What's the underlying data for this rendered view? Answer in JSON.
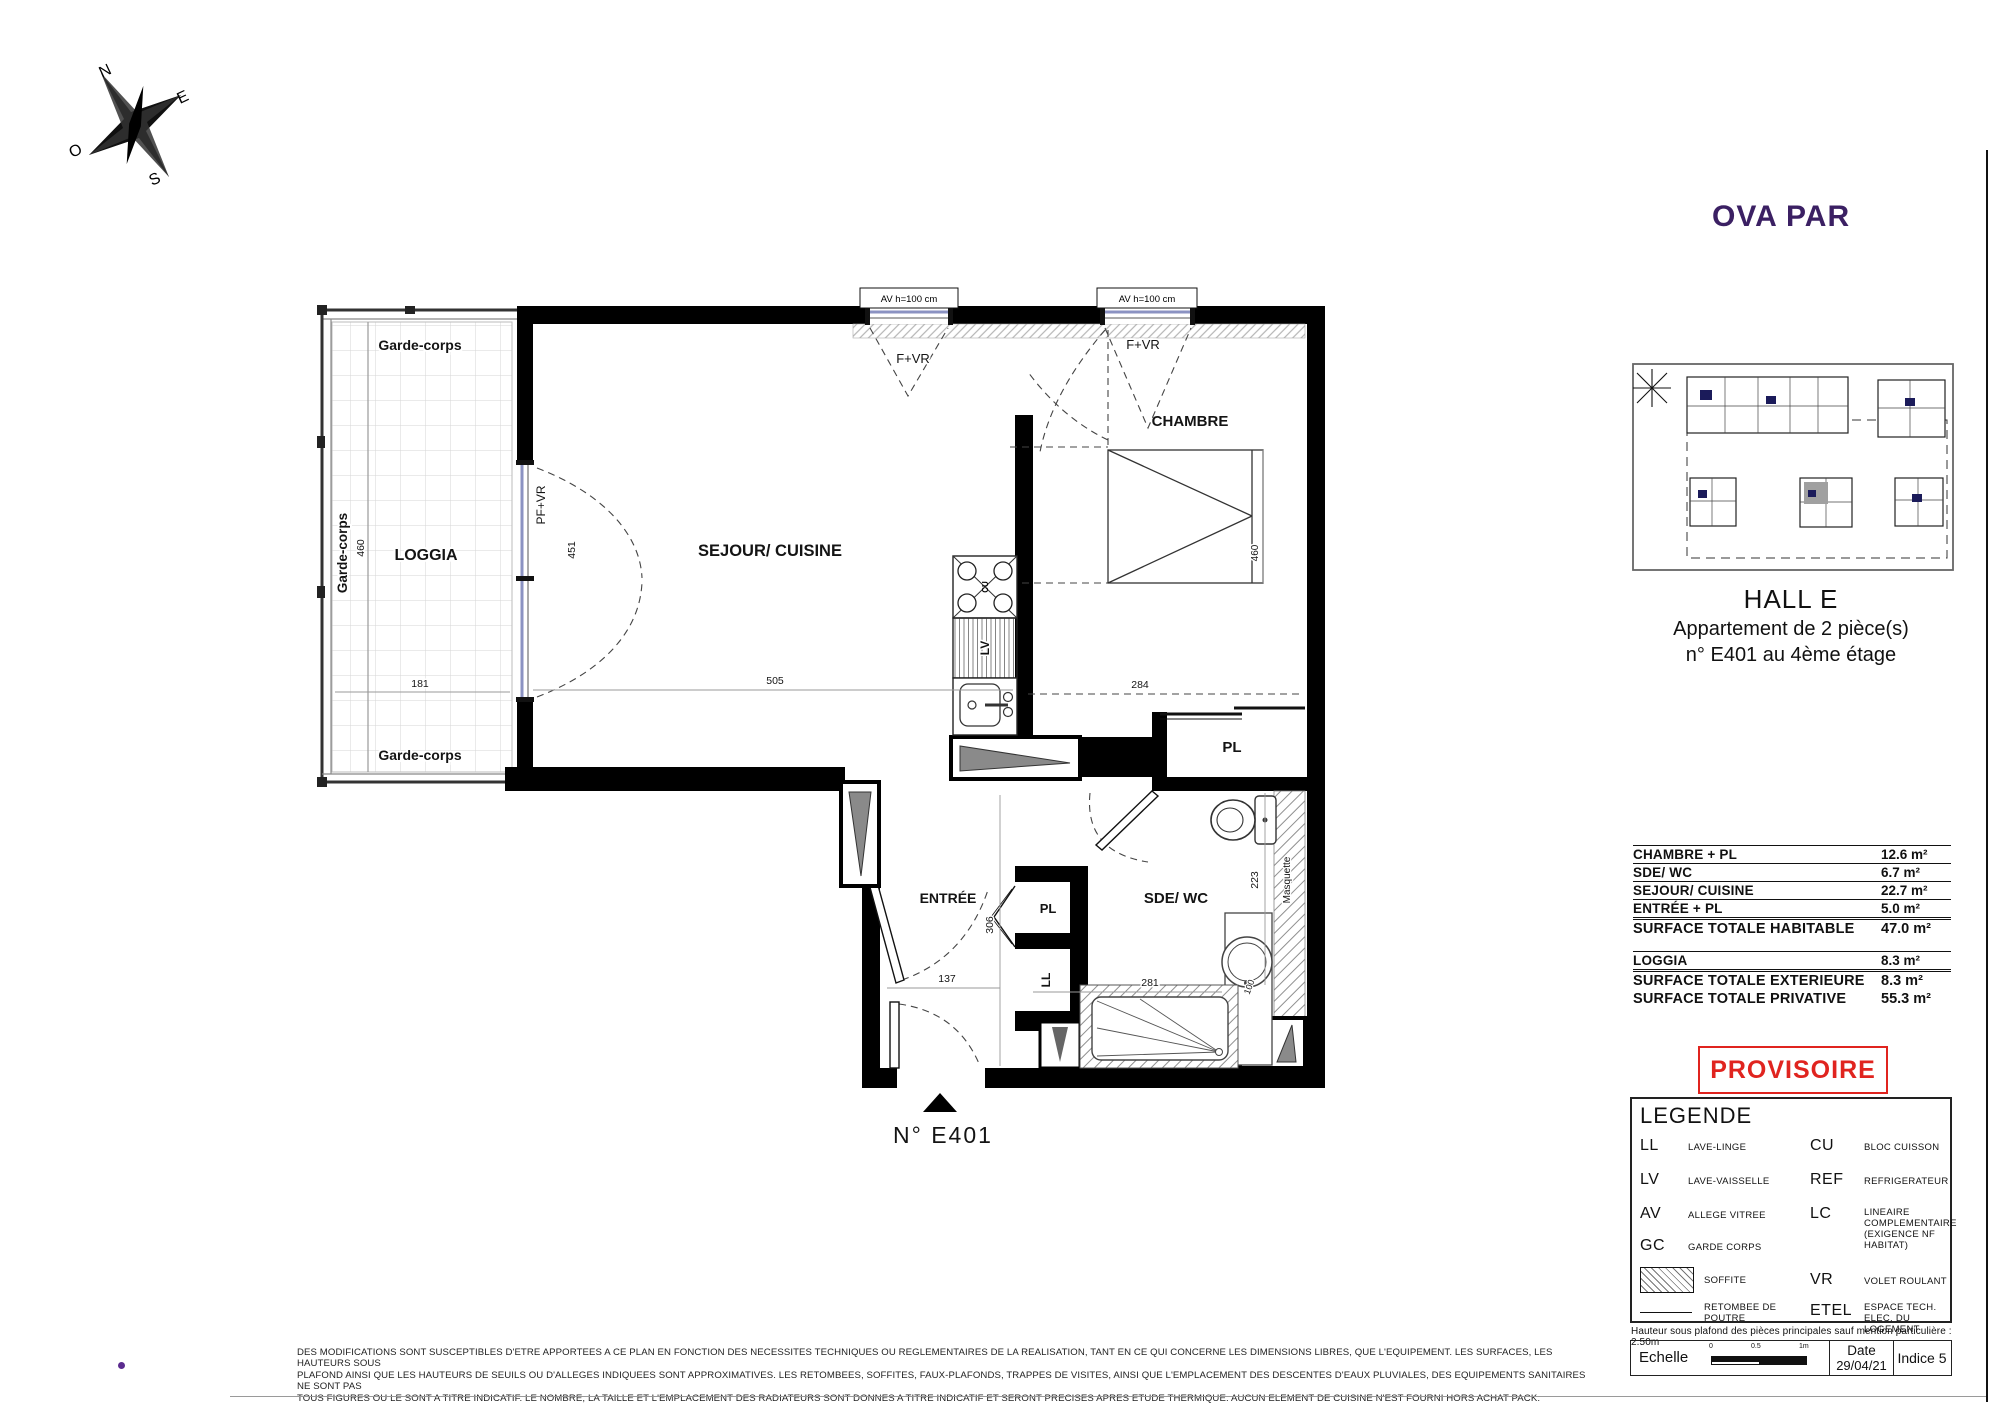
{
  "page": {
    "logo": "OVA PAR",
    "logo_color": "#3b2063",
    "accent_red": "#e0241f",
    "navy": "#1b1b5a"
  },
  "compass": {
    "n": "N",
    "e": "E",
    "s": "S",
    "o": "O"
  },
  "plan": {
    "rooms": {
      "loggia": "LOGGIA",
      "sejour": "SEJOUR/ CUISINE",
      "chambre": "CHAMBRE",
      "entree": "ENTRÉE",
      "sde": "SDE/ WC",
      "pl_chambre": "PL",
      "pl_entree": "PL",
      "ll": "LL",
      "lv": "LV",
      "cu": "CU"
    },
    "labels": {
      "garde_corps": "Garde-corps",
      "pf_vr": "PF+VR",
      "f_vr": "F+VR",
      "av": "AV h=100 cm",
      "masquette": "Masquette",
      "unit": "N°  E401"
    },
    "dims": {
      "loggia_w": "181",
      "loggia_h": "460",
      "sejour_w": "505",
      "sejour_door": "451",
      "chambre_w": "284",
      "chambre_h": "460",
      "entree_w": "137",
      "entree_h": "306",
      "sde_w": "281",
      "sde_h": "223",
      "vasque": "100"
    }
  },
  "sidebar": {
    "hall": "HALL E",
    "apt_line1": "Appartement de 2 pièce(s)",
    "apt_line2": "n° E401 au  4ème étage",
    "surface_table": {
      "rows": [
        {
          "label": "CHAMBRE  + PL",
          "value": "12.6 m²"
        },
        {
          "label": "SDE/ WC",
          "value": "6.7 m²"
        },
        {
          "label": "SEJOUR/ CUISINE",
          "value": "22.7 m²"
        },
        {
          "label": "ENTRÉE  + PL",
          "value": "5.0 m²"
        },
        {
          "label": "SURFACE TOTALE HABITABLE",
          "value": "47.0 m²"
        },
        {
          "label": "LOGGIA",
          "value": "8.3 m²"
        },
        {
          "label": "SURFACE TOTALE EXTERIEURE",
          "value": "8.3 m²"
        },
        {
          "label": "SURFACE TOTALE PRIVATIVE",
          "value": "55.3 m²"
        }
      ]
    },
    "stamp": "PROVISOIRE",
    "legend": {
      "title": "LEGENDE",
      "ll_abbr": "LL",
      "ll_desc": "LAVE-LINGE",
      "lv_abbr": "LV",
      "lv_desc": "LAVE-VAISSELLE",
      "av_abbr": "AV",
      "av_desc": "ALLEGE VITREE",
      "gc_abbr": "GC",
      "gc_desc": "GARDE CORPS",
      "soffite_desc": "SOFFITE",
      "retombee_desc": "RETOMBEE DE POUTRE",
      "cu_abbr": "CU",
      "cu_desc": "BLOC CUISSON",
      "ref_abbr": "REF",
      "ref_desc": "REFRIGERATEUR",
      "lc_abbr": "LC",
      "lc_desc": "LINEAIRE COMPLEMENTAIRE (EXIGENCE NF HABITAT)",
      "vr_abbr": "VR",
      "vr_desc": "VOLET ROULANT",
      "etel_abbr": "ETEL",
      "etel_desc": "ESPACE TECH. ELEC. DU LOGEMENT"
    },
    "ceiling_note": "Hauteur sous plafond des pièces principales sauf mention particulière : 2.50m",
    "titlebar": {
      "echelle": "Echelle",
      "tick0": "0",
      "tick05": "0.5",
      "tick1": "1m",
      "date_label": "Date",
      "date_value": "29/04/21",
      "indice": "Indice 5"
    }
  },
  "disclaimer": {
    "line1": "DES MODIFICATIONS SONT SUSCEPTIBLES D'ETRE APPORTEES A CE PLAN EN FONCTION DES NECESSITES TECHNIQUES OU REGLEMENTAIRES DE LA REALISATION, TANT EN CE QUI CONCERNE LES DIMENSIONS LIBRES, QUE L'EQUIPEMENT. LES SURFACES, LES HAUTEURS SOUS",
    "line2": "PLAFOND AINSI QUE LES HAUTEURS DE SEUILS OU D'ALLEGES INDIQUEES SONT APPROXIMATIVES. LES RETOMBEES, SOFFITES, FAUX-PLAFONDS, TRAPPES DE VISITES, AINSI QUE L'EMPLACEMENT DES DESCENTES D'EAUX PLUVIALES, DES EQUIPEMENTS SANITAIRES NE SONT PAS",
    "line3": "TOUS FIGURES OU LE SONT A TITRE INDICATIF. LE NOMBRE, LA TAILLE ET L'EMPLACEMENT DES RADIATEURS SONT DONNES A TITRE INDICATIF ET SERONT PRECISES APRES ETUDE THERMIQUE. AUCUN ELEMENT DE CUISINE N'EST FOURNI HORS ACHAT PACK."
  }
}
